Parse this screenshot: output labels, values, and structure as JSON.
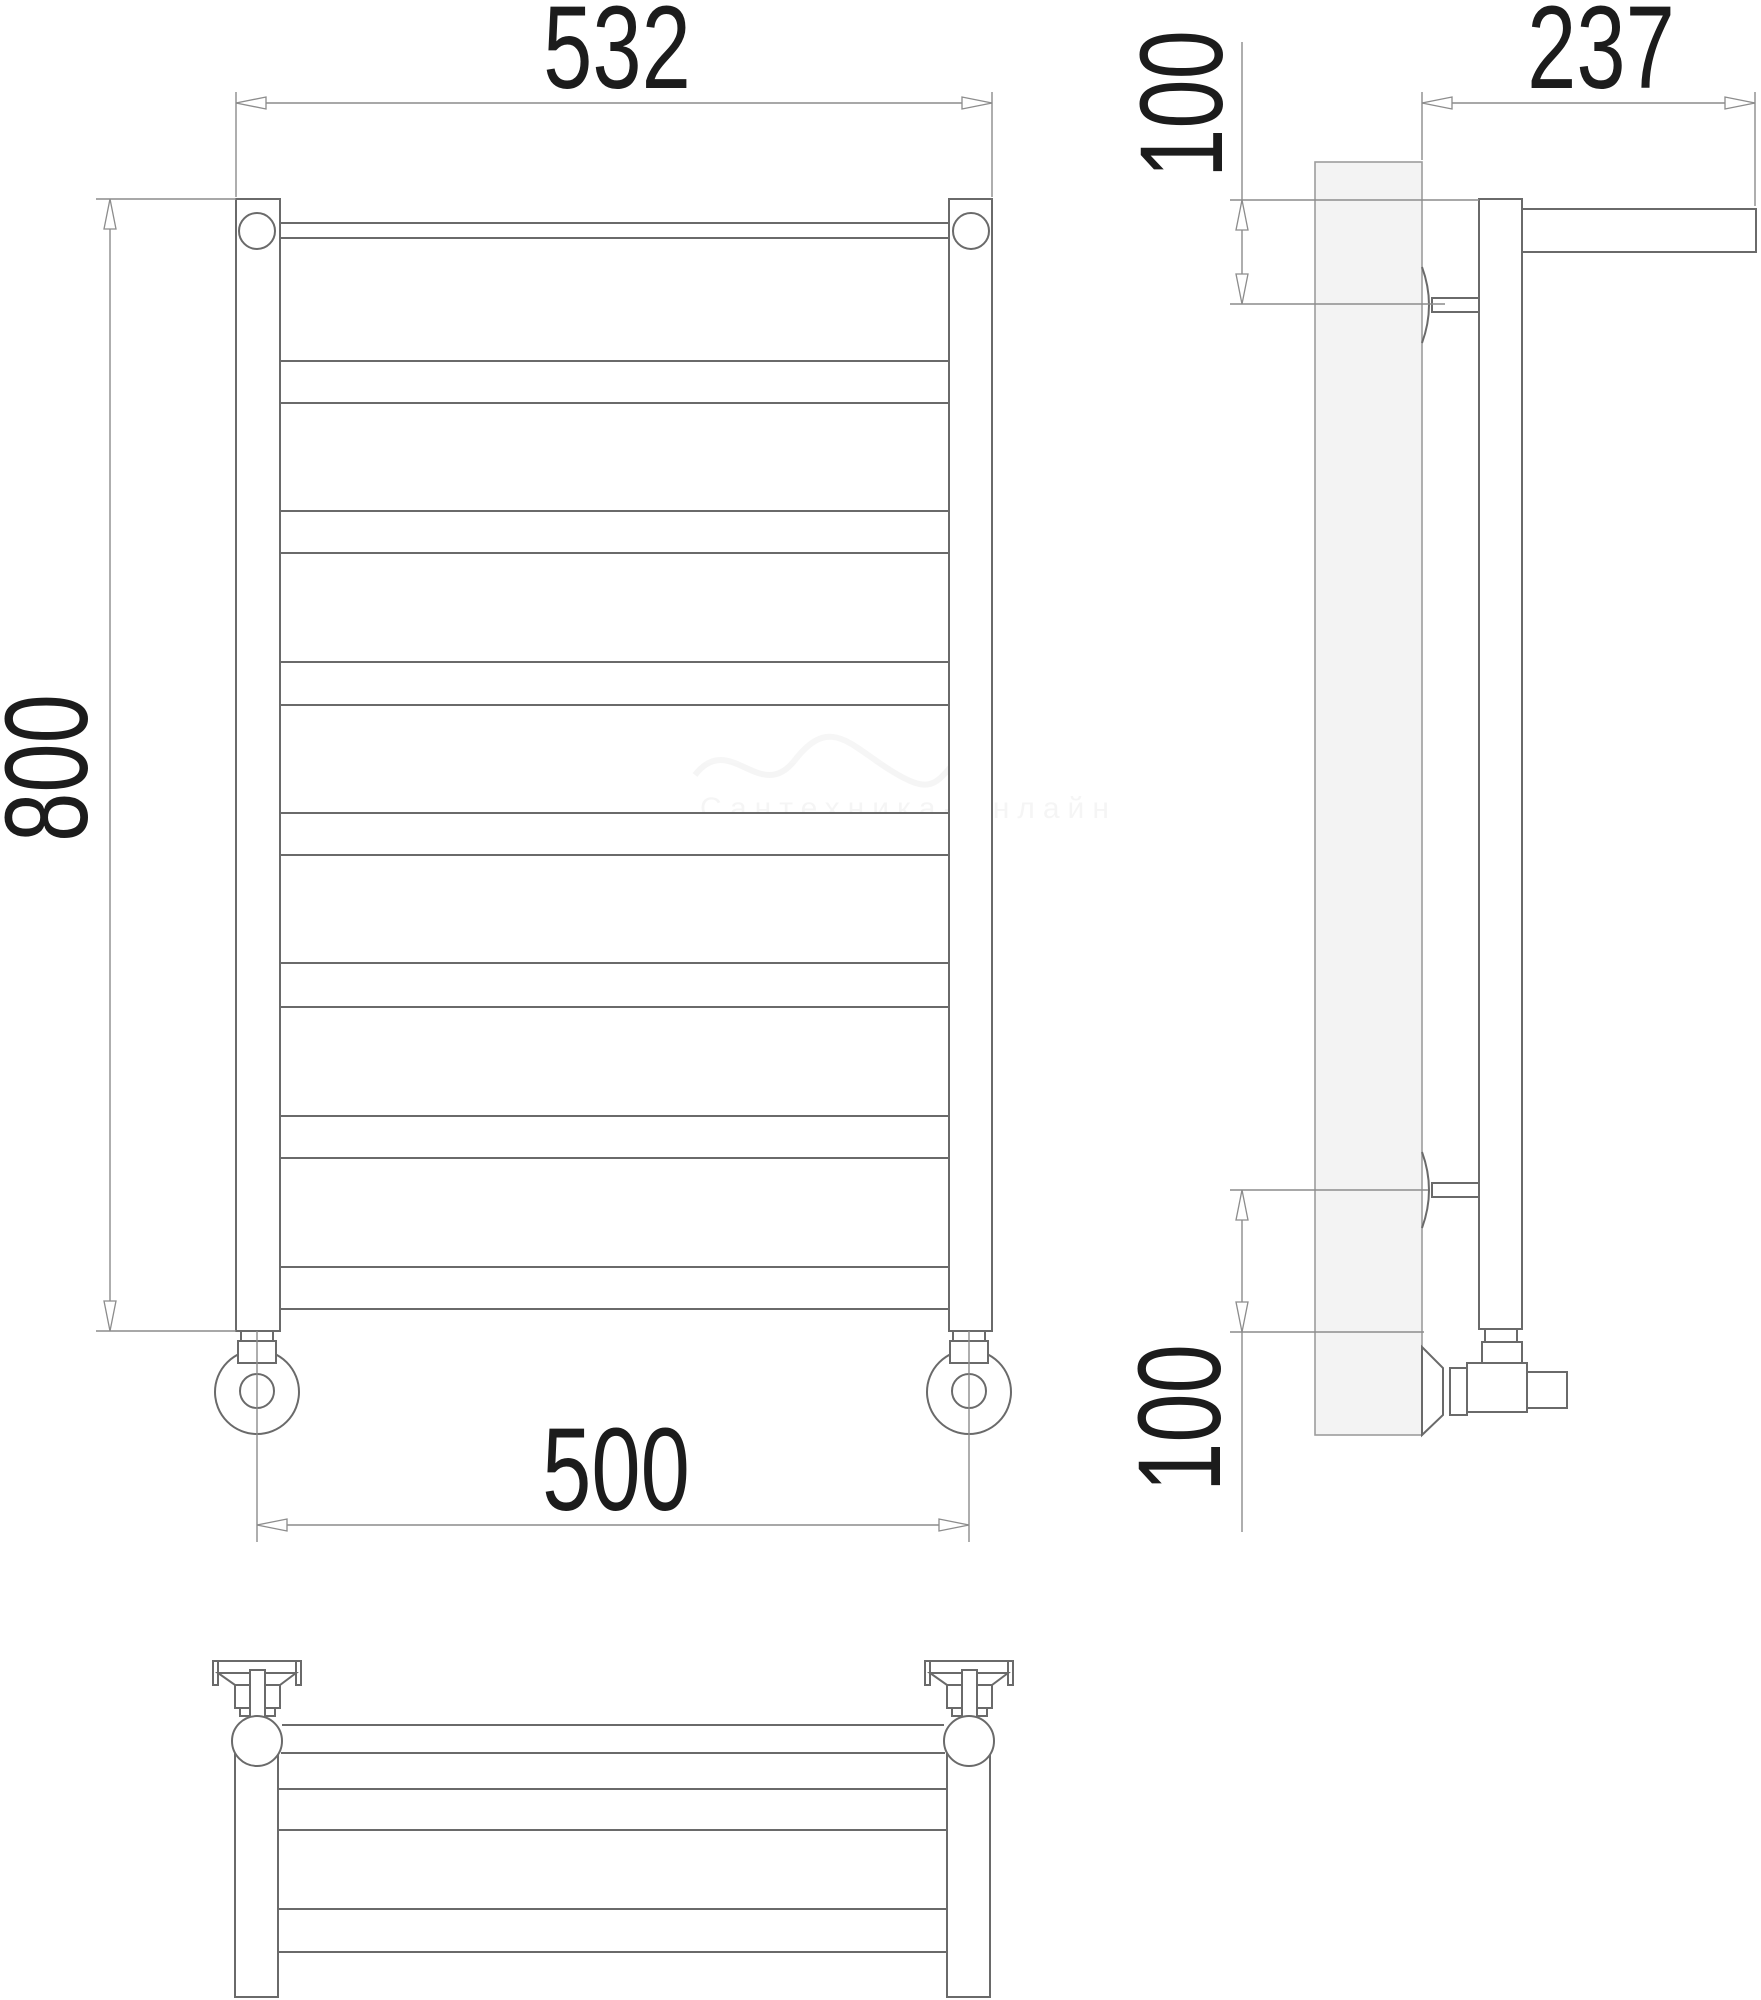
{
  "drawing": {
    "kind": "technical dimension drawing",
    "subject": "ladder towel rail with top shelf, three orthographic views",
    "views": [
      "front-view",
      "side-view",
      "top-view"
    ]
  },
  "dimensions": {
    "overall_width": "532",
    "depth": "237",
    "height": "800",
    "top_bracket_offset": "100",
    "connection_spacing": "500",
    "bottom_bracket_offset": "100"
  },
  "watermark": {
    "text": "Сантехника-Онлайн"
  },
  "colors": {
    "line": "#6a6a6a",
    "dim": "#8c8c8c",
    "ink": "#1c1c1c",
    "plate": "#f3f3f3",
    "background": "#ffffff"
  }
}
